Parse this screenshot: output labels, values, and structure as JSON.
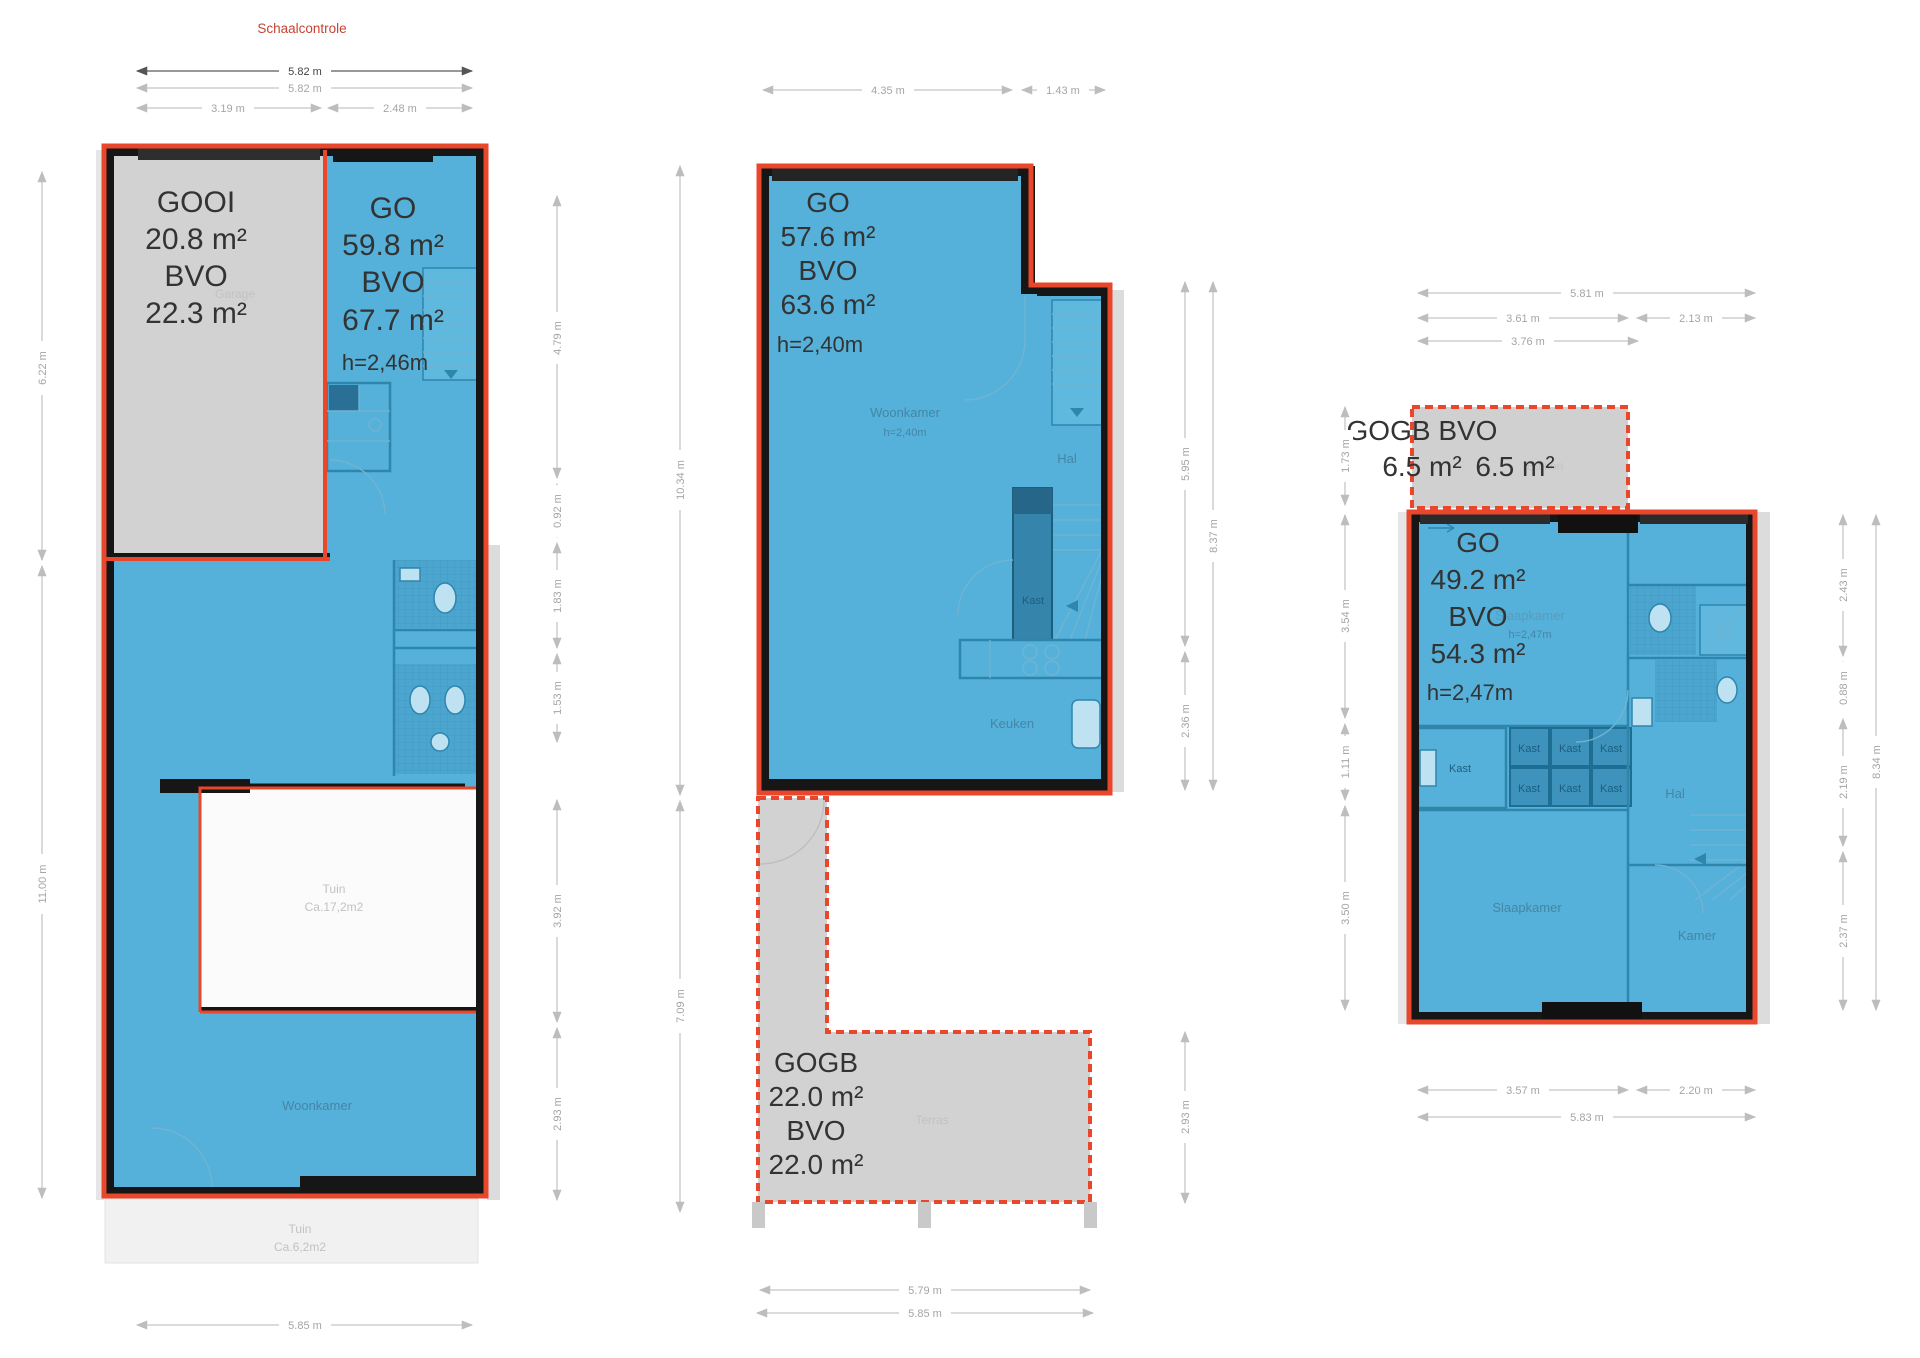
{
  "page": {
    "title": "Schaalcontrole"
  },
  "colors": {
    "unit_fill_blue": "#55b1da",
    "overlay_gray": "#d2d2d2",
    "outline_red": "#e8472c",
    "wall_black": "#161616",
    "dim_gray": "#c5c5c5"
  },
  "plan1": {
    "garage_block": {
      "l1": "GOOI",
      "l2": "20.8 m²",
      "l3": "BVO",
      "l4": "22.3 m²"
    },
    "go_block": {
      "l1": "GO",
      "l2": "59.8 m²",
      "l3": "BVO",
      "l4": "67.7 m²",
      "l5": "h=2,46m"
    },
    "rooms": {
      "garage": "Garage",
      "woonkamer": "Woonkamer",
      "tuin1_name": "Tuin",
      "tuin1_area": "Ca.17,2m2",
      "tuin2_name": "Tuin",
      "tuin2_area": "Ca.6,2m2"
    },
    "dims": {
      "top_total": "5.82 m",
      "top_total2": "5.82 m",
      "top_left": "3.19 m",
      "top_right": "2.48 m",
      "left_upper": "6.22 m",
      "left_lower": "11.00 m",
      "right_1": "4.79 m",
      "right_2": "0.92 m",
      "right_3": "1.83 m",
      "right_4": "1.53 m",
      "right_5": "3.92 m",
      "right_6": "2.93 m",
      "bottom": "5.85 m"
    }
  },
  "plan2": {
    "go_block": {
      "l1": "GO",
      "l2": "57.6 m²",
      "l3": "BVO",
      "l4": "63.6 m²",
      "l5": "h=2,40m"
    },
    "gogb_block": {
      "l1": "GOGB",
      "l2": "22.0 m²",
      "l3": "BVO",
      "l4": "22.0 m²"
    },
    "rooms": {
      "woonkamer": "Woonkamer",
      "woonkamer_h": "h=2,40m",
      "hal": "Hal",
      "kast": "Kast",
      "keuken": "Keuken",
      "terras": "Terras"
    },
    "dims": {
      "top_left": "4.35 m",
      "top_right": "1.43 m",
      "left_upper": "10.34 m",
      "left_lower": "7.09 m",
      "right_1": "5.95 m",
      "right_2": "2.36 m",
      "right_3": "2.93 m",
      "right_total": "8.37 m",
      "bottom_1": "5.79 m",
      "bottom_2": "5.85 m"
    }
  },
  "plan3": {
    "gogb_block": {
      "l1": "GOGB BVO",
      "l2a": "6.5 m²",
      "l2b": "6.5 m²"
    },
    "go_block": {
      "l1": "GO",
      "l2": "49.2 m²",
      "l3": "BVO",
      "l4": "54.3 m²",
      "l5": "h=2,47m"
    },
    "rooms": {
      "balkon": "Balkon",
      "slaapkamer_label": "Slaapkamer",
      "slaapkamer_h": "h=2,47m",
      "kast": "Kast",
      "hal": "Hal",
      "slaapkamer": "Slaapkamer",
      "kamer": "Kamer"
    },
    "dims": {
      "top_total": "5.81 m",
      "top_left": "3.61 m",
      "top_right": "2.13 m",
      "top_left2": "3.76 m",
      "left_1": "1.73 m",
      "left_2": "3.54 m",
      "left_3": "1.11 m",
      "left_4": "3.50 m",
      "right_1": "2.43 m",
      "right_2": "0.88 m",
      "right_3": "2.19 m",
      "right_4": "2.37 m",
      "right_total": "8.34 m",
      "bottom_left": "3.57 m",
      "bottom_right": "2.20 m",
      "bottom_total": "5.83 m"
    }
  }
}
